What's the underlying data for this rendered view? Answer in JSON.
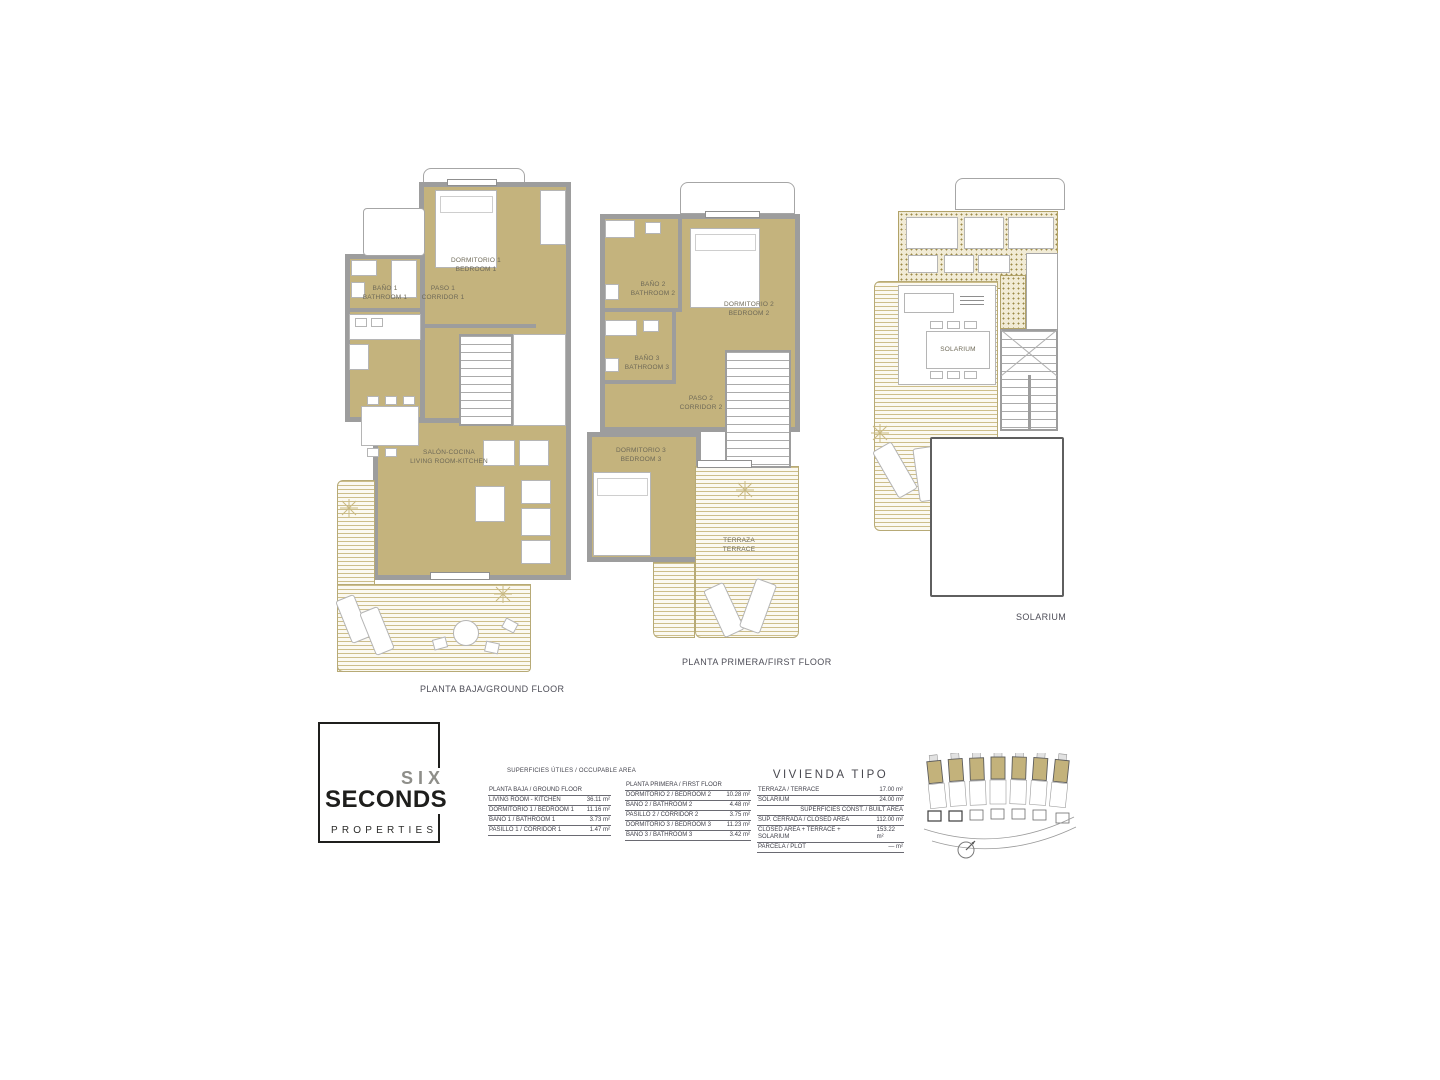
{
  "document": {
    "captions": {
      "ground": "PLANTA BAJA/GROUND FLOOR",
      "first": "PLANTA PRIMERA/FIRST FLOOR",
      "solarium": "SOLARIUM"
    },
    "rooms": {
      "ground": {
        "bedroom1": {
          "l1": "DORMITORIO 1",
          "l2": "BEDROOM 1"
        },
        "bath1": {
          "l1": "BAÑO 1",
          "l2": "BATHROOM 1"
        },
        "corridor1": {
          "l1": "PASO 1",
          "l2": "CORRIDOR 1"
        },
        "living": {
          "l1": "SALÓN-COCINA",
          "l2": "LIVING ROOM-KITCHEN"
        }
      },
      "first": {
        "bath2": {
          "l1": "BAÑO 2",
          "l2": "BATHROOM 2"
        },
        "bedroom2": {
          "l1": "DORMITORIO 2",
          "l2": "BEDROOM 2"
        },
        "bath3": {
          "l1": "BAÑO 3",
          "l2": "BATHROOM 3"
        },
        "corridor2": {
          "l1": "PASO 2",
          "l2": "CORRIDOR 2"
        },
        "bedroom3": {
          "l1": "DORMITORIO 3",
          "l2": "BEDROOM 3"
        },
        "terrace": {
          "l1": "TERRAZA",
          "l2": "TERRACE"
        }
      },
      "solarium": {
        "solarium_label": "SOLARIUM"
      }
    }
  },
  "logo": {
    "six": "SIX",
    "seconds": "SECONDS",
    "properties": "PROPERTIES"
  },
  "tables": {
    "occupable_header": "SUPERFICIES ÚTILES / OCCUPABLE AREA",
    "ground": {
      "title": "PLANTA BAJA / GROUND FLOOR",
      "rows": [
        {
          "label": "LIVING ROOM - KITCHEN",
          "value": "36.11 m²"
        },
        {
          "label": "DORMITORIO 1 / BEDROOM 1",
          "value": "11.16 m²"
        },
        {
          "label": "BAÑO 1 / BATHROOM 1",
          "value": "3.73 m²"
        },
        {
          "label": "PASILLO 1 / CORRIDOR 1",
          "value": "1.47 m²"
        }
      ]
    },
    "first": {
      "title": "PLANTA PRIMERA / FIRST FLOOR",
      "rows": [
        {
          "label": "DORMITORIO 2 / BEDROOM 2",
          "value": "10.28 m²"
        },
        {
          "label": "BAÑO 2 / BATHROOM 2",
          "value": "4.48 m²"
        },
        {
          "label": "PASILLO 2 / CORRIDOR 2",
          "value": "3.75 m²"
        },
        {
          "label": "DORMITORIO 3 / BEDROOM 3",
          "value": "11.23 m²"
        },
        {
          "label": "BAÑO 3 / BATHROOM 3",
          "value": "3.42 m²"
        }
      ]
    },
    "vivienda": {
      "title": "VIVIENDA TIPO",
      "rows_top": [
        {
          "label": "TERRAZA / TERRACE",
          "value": "17.00 m²"
        },
        {
          "label": "SOLARIUM",
          "value": "24.00 m²"
        }
      ],
      "subheader": "SUPERFICIES  CONST. / BUILT AREA",
      "rows_bottom": [
        {
          "label": "SUP. CERRADA / CLOSED AREA",
          "value": "112.00 m²"
        },
        {
          "label": "CLOSED AREA + TERRACE + SOLARIUM",
          "value": "153.22 m²"
        },
        {
          "label": "PARCELA / PLOT",
          "value": "— m²"
        }
      ]
    }
  },
  "colors": {
    "room_fill": "#c4b37d",
    "wall": "#9d9d9d",
    "deck_stripe": "#cdbe8a",
    "logo_black": "#1f1f1d",
    "logo_gray": "#8e8e89"
  }
}
